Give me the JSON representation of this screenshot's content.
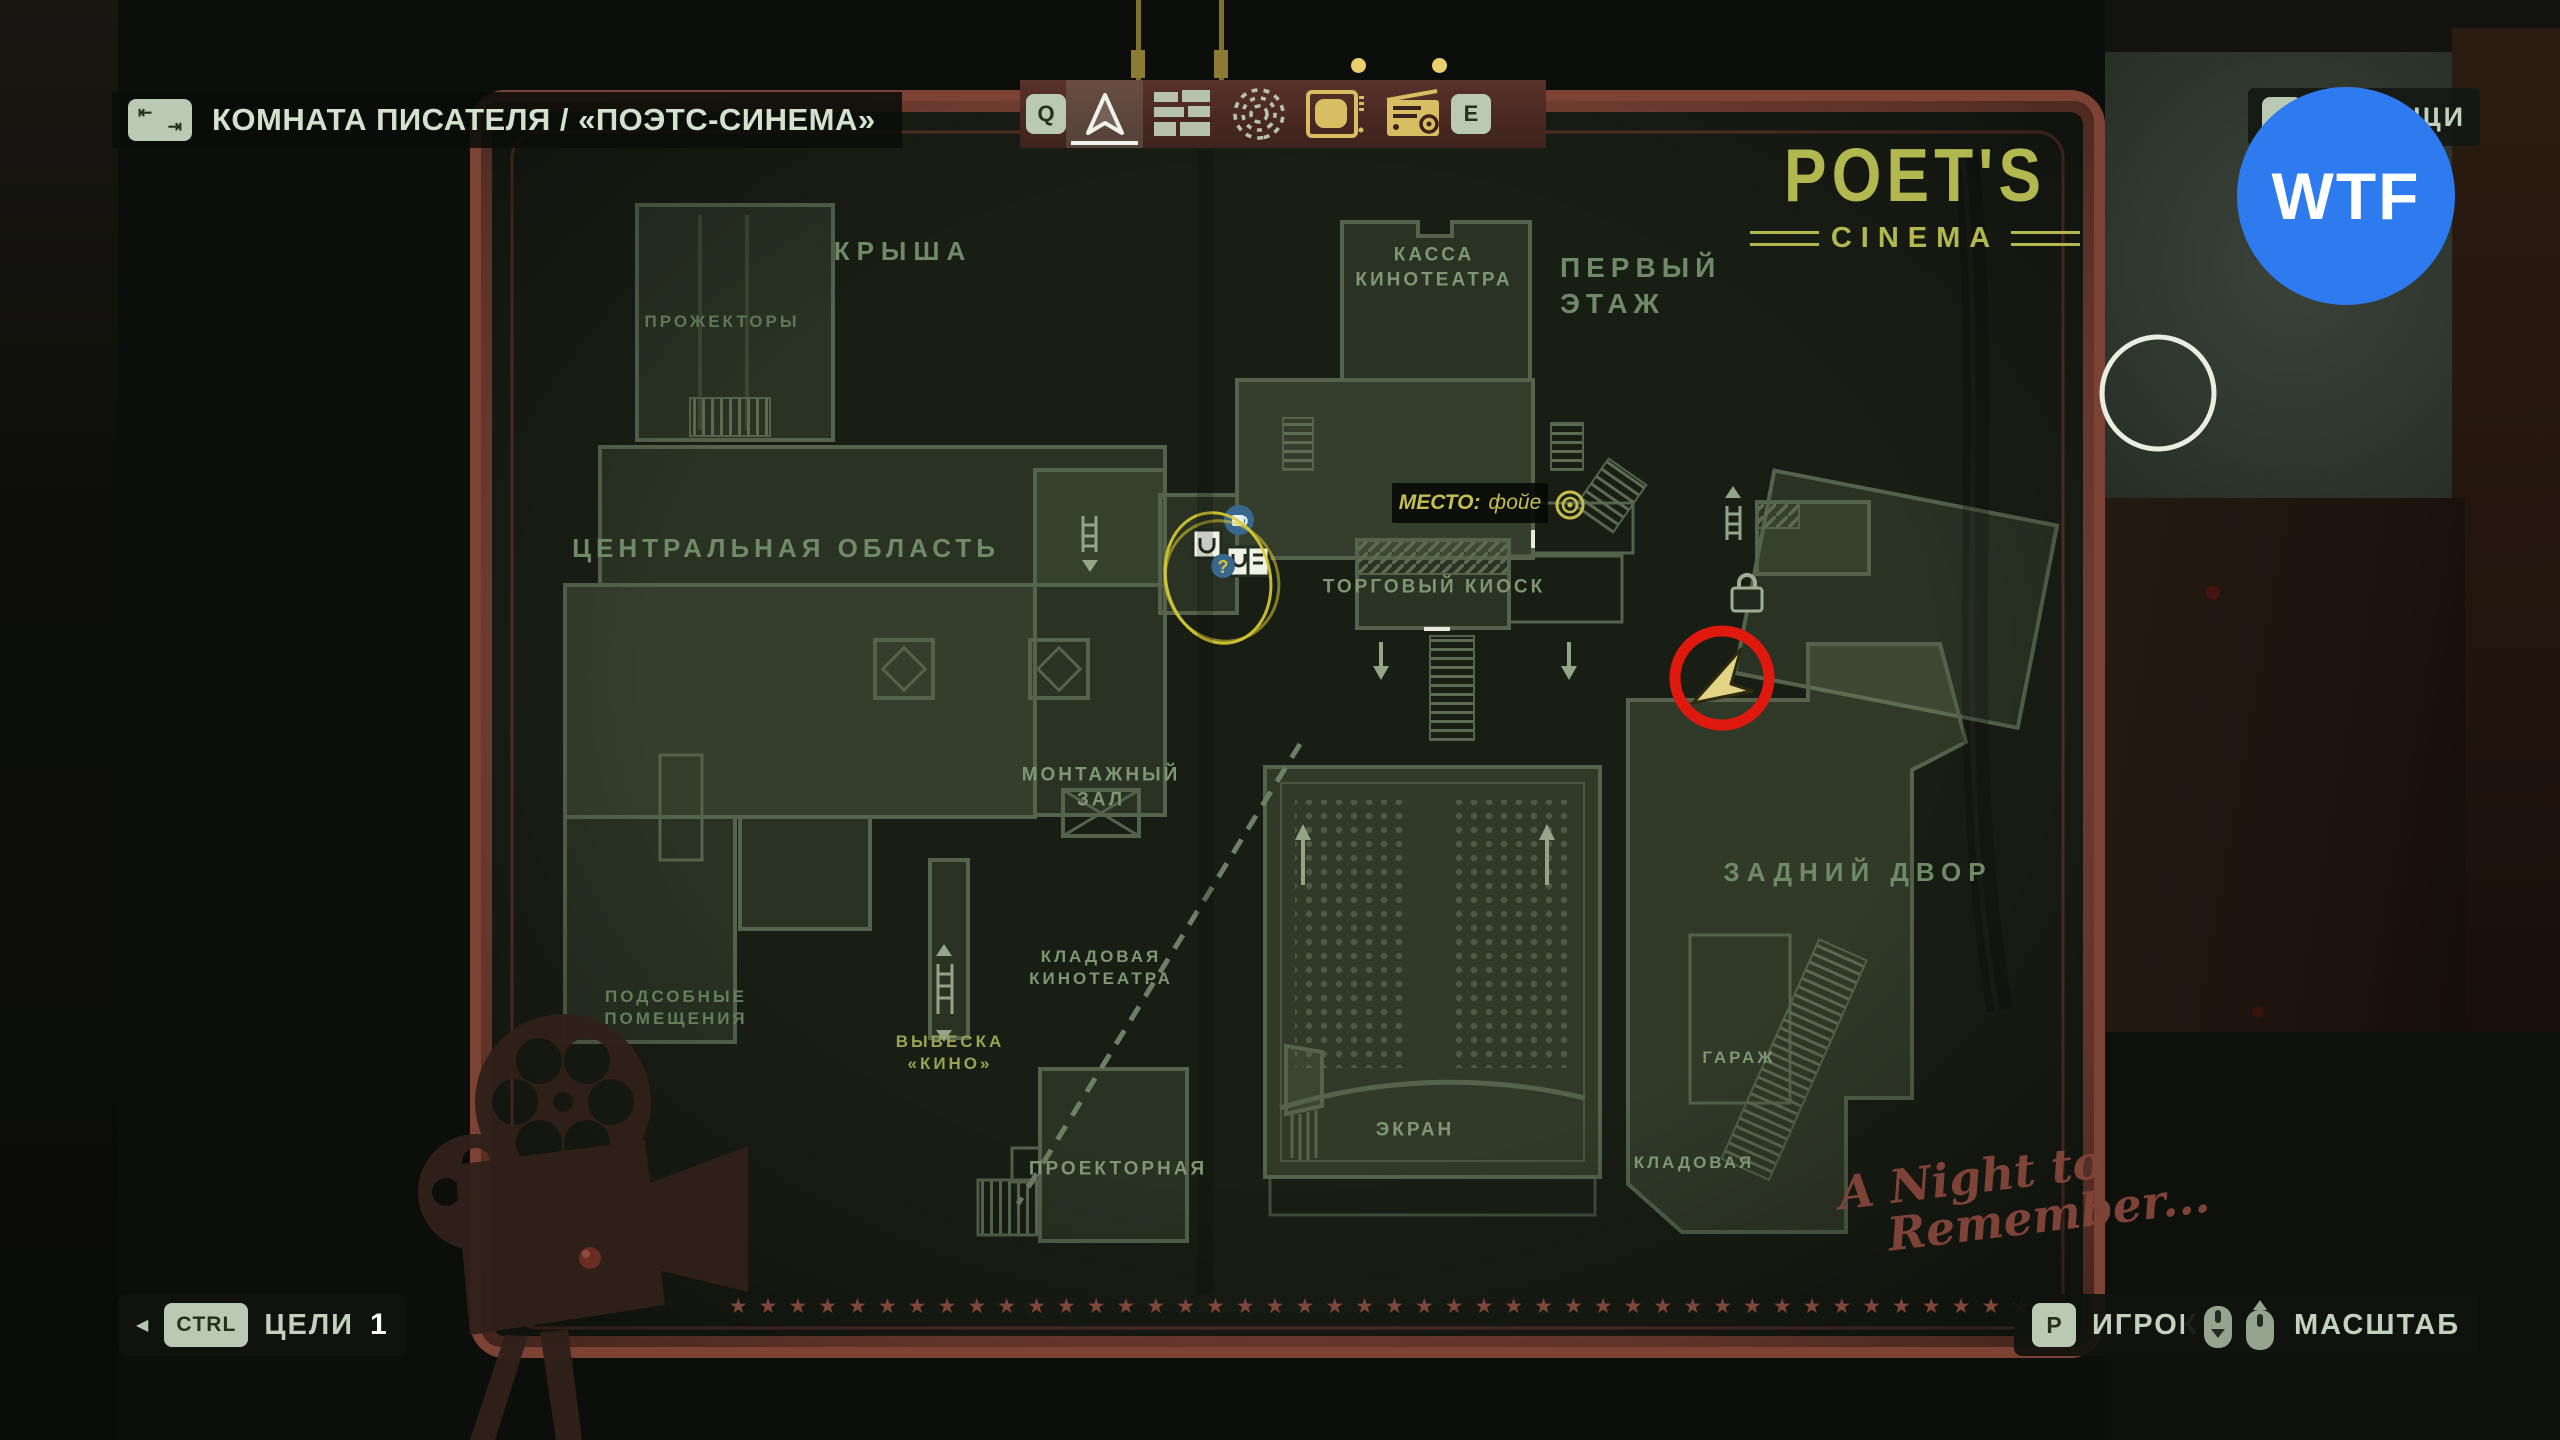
{
  "header": {
    "title": "КОМНАТА ПИСАТЕЛЯ / «ПОЭТС-СИНЕМА»"
  },
  "icons": {
    "tab_top": "⇤",
    "tab_bottom": "⇥",
    "triangle_left": "◀",
    "question_mark": "?"
  },
  "toolbar": {
    "key_prev": "Q",
    "key_next": "E",
    "tools": [
      {
        "name": "map-cursor",
        "selected": true
      },
      {
        "name": "plot-board",
        "selected": false
      },
      {
        "name": "echoes-spiral",
        "selected": false
      },
      {
        "name": "tv",
        "selected": false,
        "notification": true
      },
      {
        "name": "radio",
        "selected": false,
        "notification": true
      }
    ]
  },
  "items_button": {
    "label": "ВЕЩИ"
  },
  "watermark": {
    "text": "WTF",
    "color": "#2e7bef"
  },
  "map": {
    "logo_line1": "POET'S",
    "logo_line2": "CINEMA",
    "tagline_line1": "A Night to",
    "tagline_line2": "Remember...",
    "location_label": "МЕСТО:",
    "location_value": "фойе",
    "stars": "★★★★★★★★★★★★★★★★★★★★★★★★★★★★★★★★★★★★★★★★★★★★",
    "labels": [
      {
        "text": "КРЫША"
      },
      {
        "text": "ПРОЖЕКТОРЫ"
      },
      {
        "text": "ЦЕНТРАЛЬНАЯ ОБЛАСТЬ"
      },
      {
        "text": "ПОДСОБНЫЕ\nПОМЕЩЕНИЯ"
      },
      {
        "text": "ВЫВЕСКА\n«КИНО»"
      },
      {
        "text": "МОНТАЖНЫЙ\nЗАЛ"
      },
      {
        "text": "КЛАДОВАЯ\nКИНОТЕАТРА"
      },
      {
        "text": "ПРОЕКТОРНАЯ"
      },
      {
        "text": "КАССА\nКИНОТЕАТРА"
      },
      {
        "text": "ПЕРВЫЙ\nЭТАЖ"
      },
      {
        "text": "ТОРГОВЫЙ КИОСК"
      },
      {
        "text": "ЭКРАН"
      },
      {
        "text": "ЗАДНИЙ ДВОР"
      },
      {
        "text": "ГАРАЖ"
      },
      {
        "text": "КЛАДОВАЯ"
      }
    ]
  },
  "footer": {
    "objectives_key": "CTRL",
    "objectives_label": "ЦЕЛИ",
    "objectives_count": "1",
    "player_key": "P",
    "player_label": "ИГРОК",
    "zoom_label": "МАСШТАБ"
  },
  "colors": {
    "accent_gold": "#d8bd62",
    "map_label_green": "#7e9671",
    "border_red": "#7c4335",
    "annotation_red": "#e0190f",
    "annotation_yellow": "#d9cb33",
    "watermark_blue": "#2e7bef"
  }
}
